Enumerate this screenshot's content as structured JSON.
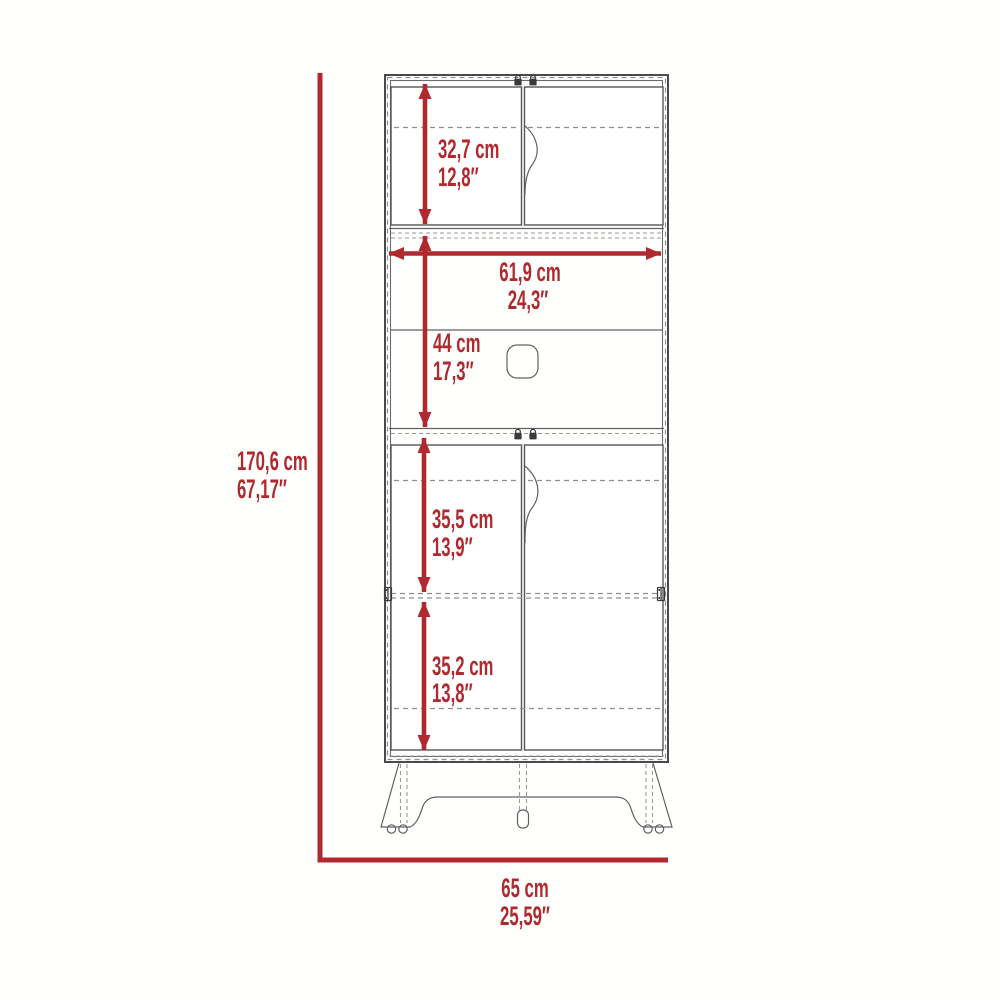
{
  "diagram": {
    "type": "furniture-dimension-diagram",
    "subject": "tall pantry cabinet front elevation with doors, open shelf and legs",
    "colors": {
      "dimension_red": "#b0292e",
      "outline_dark": "#4a4a4a",
      "hidden_line_gray": "#8f8f8f",
      "background": "#ffffff"
    },
    "dimensions": {
      "overall_height": {
        "metric": "170,6 cm",
        "imperial": "67,17″"
      },
      "overall_width": {
        "metric": "65 cm",
        "imperial": "25,59″"
      },
      "upper_door_height": {
        "metric": "32,7 cm",
        "imperial": "12,8″"
      },
      "interior_width": {
        "metric": "61,9 cm",
        "imperial": "24,3″"
      },
      "open_section_height": {
        "metric": "44 cm",
        "imperial": "17,3″"
      },
      "lower_upper_height": {
        "metric": "35,5 cm",
        "imperial": "13,9″"
      },
      "lower_bottom_height": {
        "metric": "35,2 cm",
        "imperial": "13,8″"
      }
    }
  }
}
